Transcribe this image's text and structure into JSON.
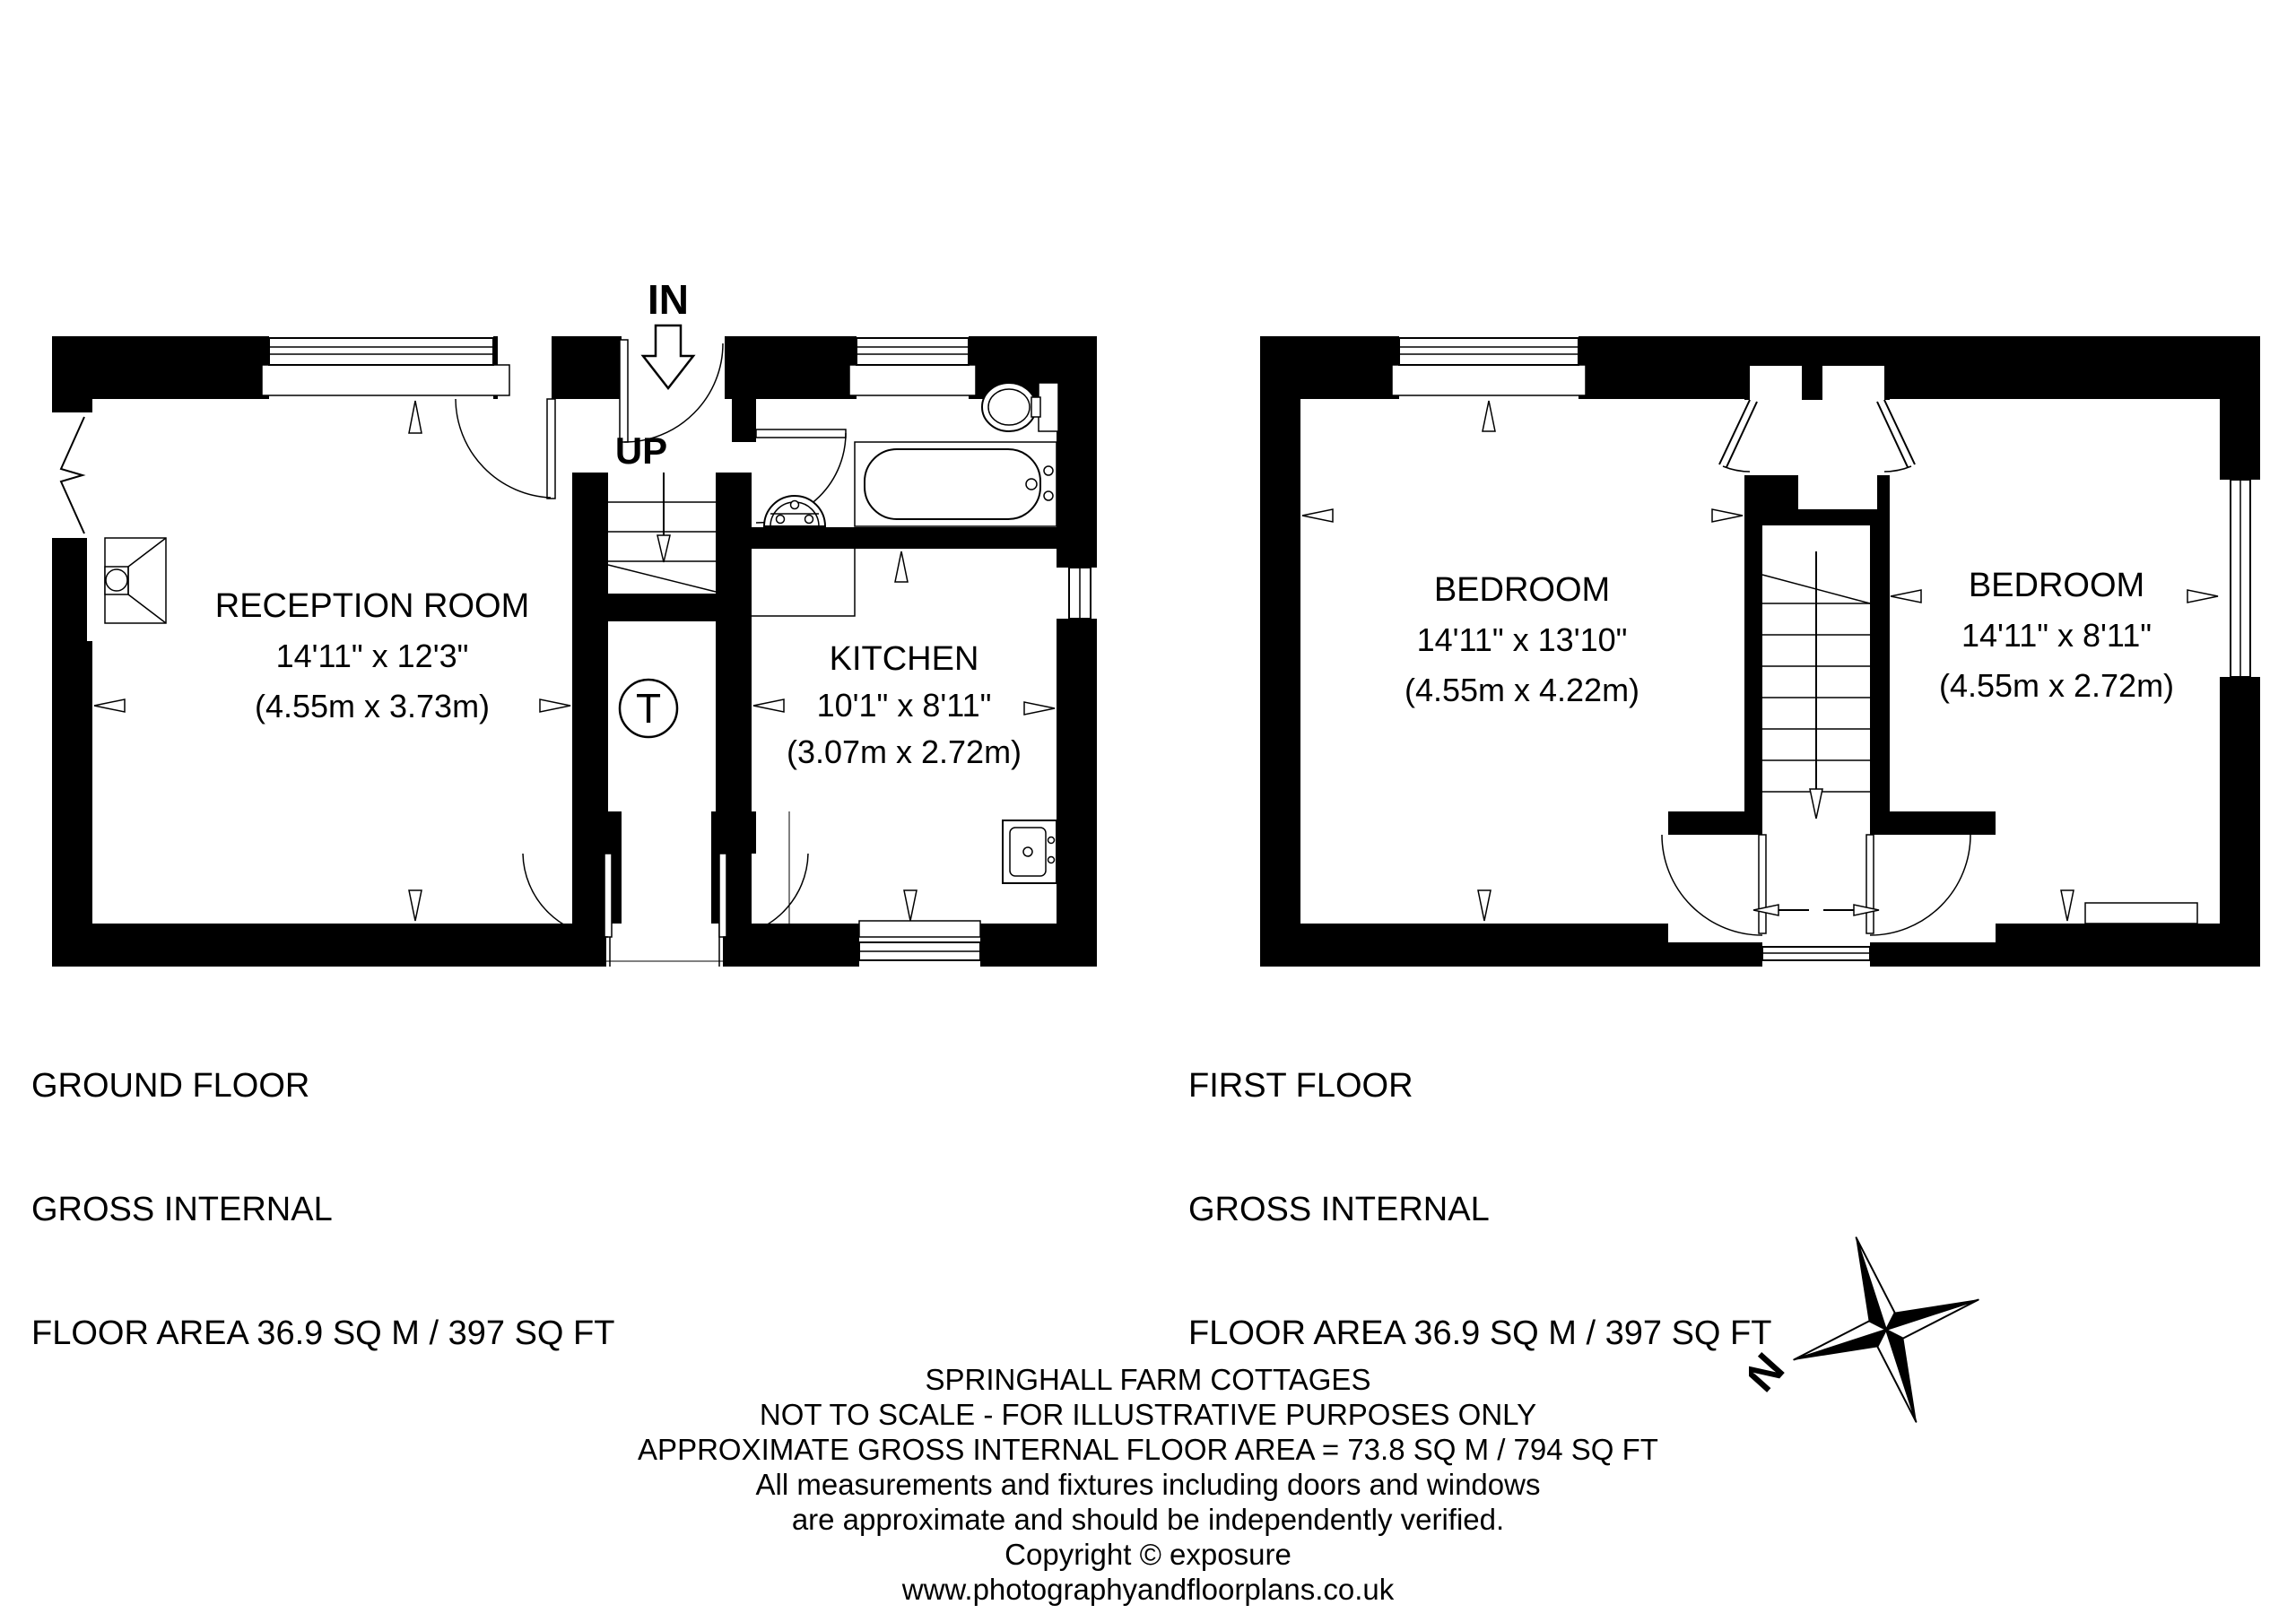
{
  "page": {
    "background": "#ffffff",
    "ink": "#000000"
  },
  "ground_floor": {
    "title": [
      "GROUND FLOOR",
      "GROSS INTERNAL",
      "FLOOR AREA 36.9 SQ M / 397 SQ FT"
    ],
    "labels": {
      "entrance": "IN",
      "stairs": "UP",
      "tank": "T"
    },
    "rooms": {
      "reception": {
        "name": "RECEPTION ROOM",
        "imperial": "14'11\" x 12'3\"",
        "metric": "(4.55m x 3.73m)"
      },
      "kitchen": {
        "name": "KITCHEN",
        "imperial": "10'1\" x 8'11\"",
        "metric": "(3.07m x 2.72m)"
      }
    }
  },
  "first_floor": {
    "title": [
      "FIRST FLOOR",
      "GROSS INTERNAL",
      "FLOOR AREA 36.9 SQ M / 397 SQ FT"
    ],
    "rooms": {
      "bedroom_left": {
        "name": "BEDROOM",
        "imperial": "14'11\" x 13'10\"",
        "metric": "(4.55m x 4.22m)"
      },
      "bedroom_right": {
        "name": "BEDROOM",
        "imperial": "14'11\" x 8'11\"",
        "metric": "(4.55m x 2.72m)"
      }
    }
  },
  "compass": {
    "north": "N"
  },
  "footer": {
    "lines": [
      "SPRINGHALL FARM COTTAGES",
      "NOT TO SCALE - FOR ILLUSTRATIVE PURPOSES ONLY",
      "APPROXIMATE GROSS INTERNAL FLOOR AREA = 73.8 SQ M / 794 SQ FT",
      "All measurements and fixtures including doors and windows",
      "are approximate and should be independently verified.",
      "Copyright © exposure",
      "www.photographyandfloorplans.co.uk"
    ]
  }
}
